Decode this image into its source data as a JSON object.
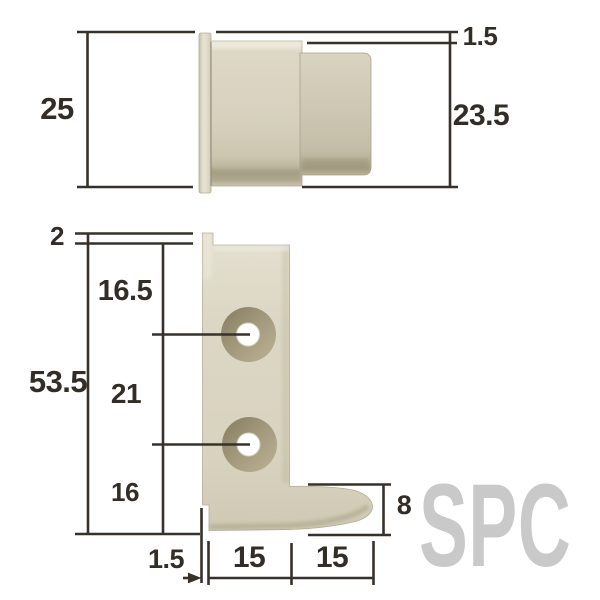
{
  "watermark": "SPC",
  "colors": {
    "line": "#37312b",
    "text": "#332d28",
    "part_light": "#ddd8c5",
    "part_mid": "#cfc9b4",
    "part_shadow": "#b0a98f",
    "counterbore": "#9a9174",
    "hole": "#ffffff",
    "watermark": "#c9c9c9",
    "background": "#ffffff"
  },
  "top_view": {
    "description": "side profile of cap part",
    "labels": {
      "total_height": "25",
      "flange_offset": "1.5",
      "body_height": "23.5"
    }
  },
  "bottom_view": {
    "description": "front view of L-shaped bracket with two counterbored screw holes",
    "labels": {
      "flange_offset": "2",
      "total_height": "53.5",
      "top_to_hole1": "16.5",
      "hole1_to_hole2": "21",
      "hole2_to_bottom": "16",
      "foot_height": "8",
      "wall_thickness": "1.5",
      "width_inner": "15",
      "width_outer": "15"
    }
  }
}
